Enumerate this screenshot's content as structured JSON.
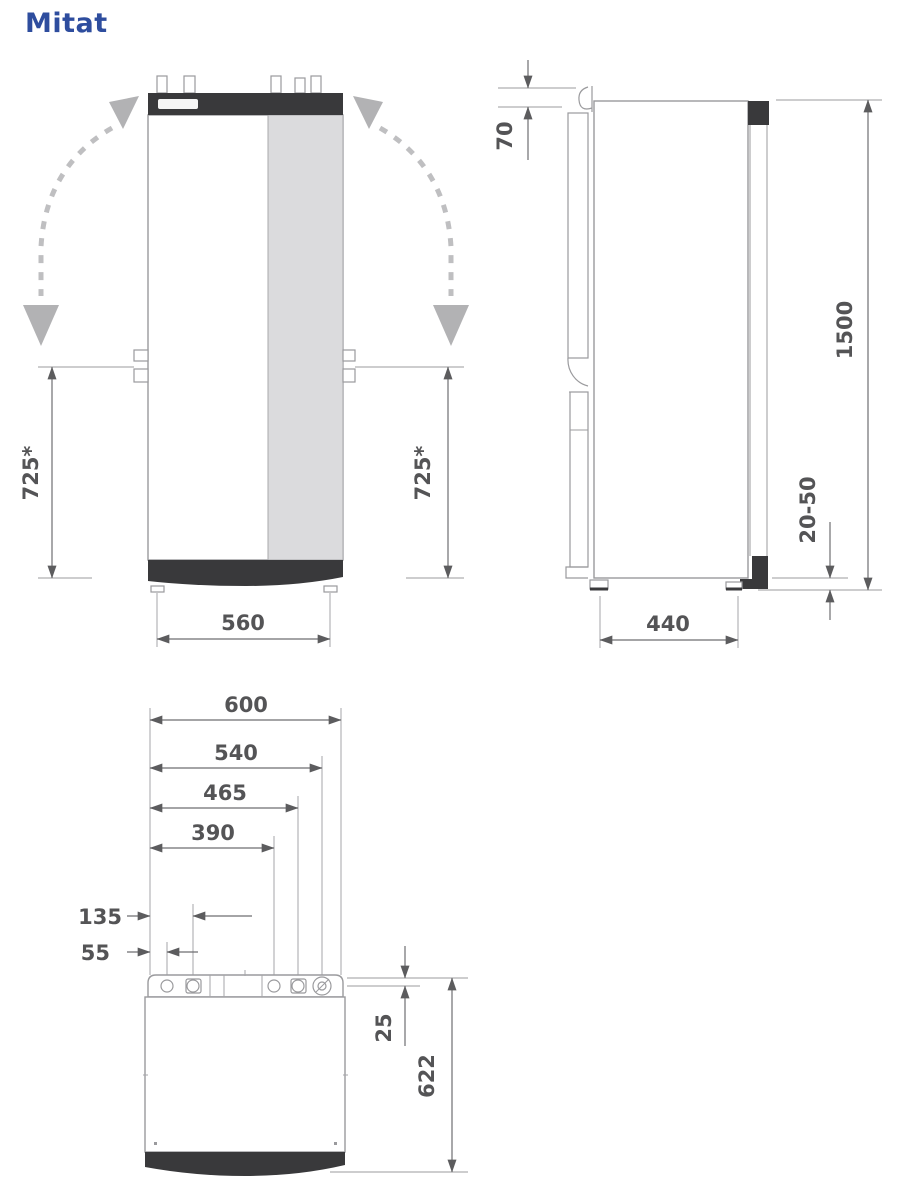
{
  "title": "Mitat",
  "front_view": {
    "dim_height_left": "725*",
    "dim_height_right": "725*",
    "dim_width": "560"
  },
  "side_view": {
    "dim_top_bracket": "70",
    "dim_height": "1500",
    "dim_foot_adjust": "20-50",
    "dim_depth": "440"
  },
  "top_view": {
    "dim_total_width": "600",
    "dim_conn_540": "540",
    "dim_conn_465": "465",
    "dim_conn_390": "390",
    "dim_conn_135": "135",
    "dim_conn_55": "55",
    "dim_pipe_back_offset": "25",
    "dim_total_depth": "622"
  },
  "colors": {
    "title_blue": "#2e4d9e",
    "panel_dark": "#39393b",
    "panel_light_gray": "#dbdbdd",
    "line_gray": "#9a9a9d",
    "dim_text_gray": "#545456",
    "swing_arrow_gray": "#b2b2b4"
  }
}
